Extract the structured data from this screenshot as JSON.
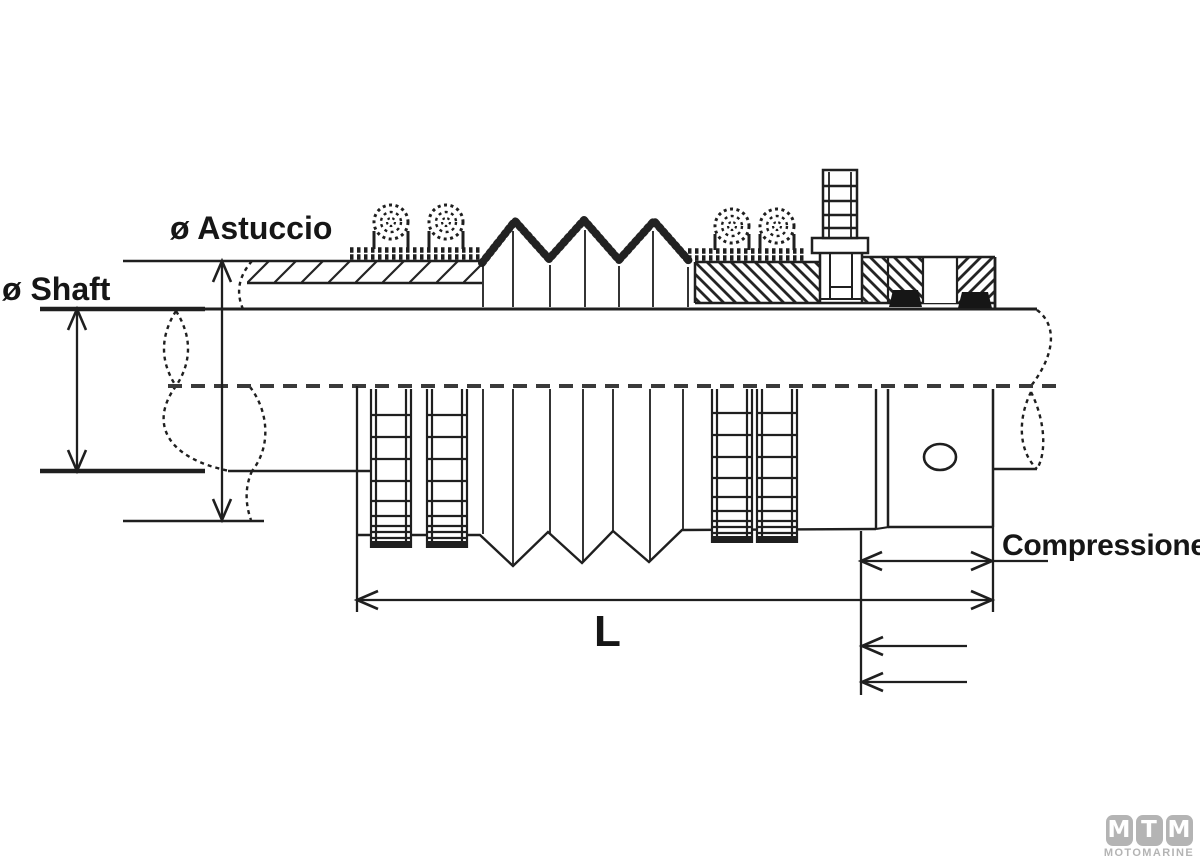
{
  "diagram": {
    "labels": {
      "astuccio_diameter": "ø Astuccio",
      "shaft_diameter": "ø Shaft",
      "compression": "Compressione",
      "length": "L"
    },
    "colors": {
      "line": "#1f1f1f",
      "centerline": "#3a3a3a",
      "logo_gray": "#b4b4b4"
    }
  },
  "logo": {
    "letters": [
      "M",
      "T",
      "M"
    ],
    "subtitle": "MOTOMARINE"
  }
}
